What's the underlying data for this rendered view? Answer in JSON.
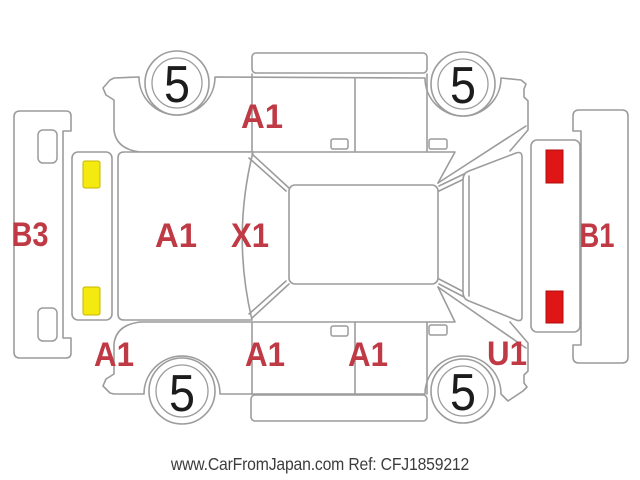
{
  "diagram": {
    "type": "vehicle-damage-map-unfolded",
    "labels": {
      "top_front_door": "A1",
      "hood": "A1",
      "windshield": "X1",
      "front_bumper": "B3",
      "rear_bumper": "B1",
      "bottom_front_fender": "A1",
      "bottom_front_door": "A1",
      "bottom_rear_door": "A1",
      "bottom_rear_fender": "U1"
    },
    "tires": {
      "top_front": "5",
      "top_rear": "5",
      "bottom_front": "5",
      "bottom_rear": "5"
    },
    "markers": {
      "front_marker_top": "yellow",
      "front_marker_bottom": "yellow",
      "tail_lamp_top": "red",
      "tail_lamp_bottom": "red"
    }
  },
  "colors": {
    "background": "#ffffff",
    "outline": "#9c9c9c",
    "damage_label": "#bf3a44",
    "marker_yellow": "#f4ea10",
    "marker_red": "#e01515",
    "tread_digit": "#1c1c1c",
    "watermark_text": "#3d3d3d"
  },
  "watermark": {
    "text": "www.CarFromJapan.com Ref: CFJ1859212"
  }
}
